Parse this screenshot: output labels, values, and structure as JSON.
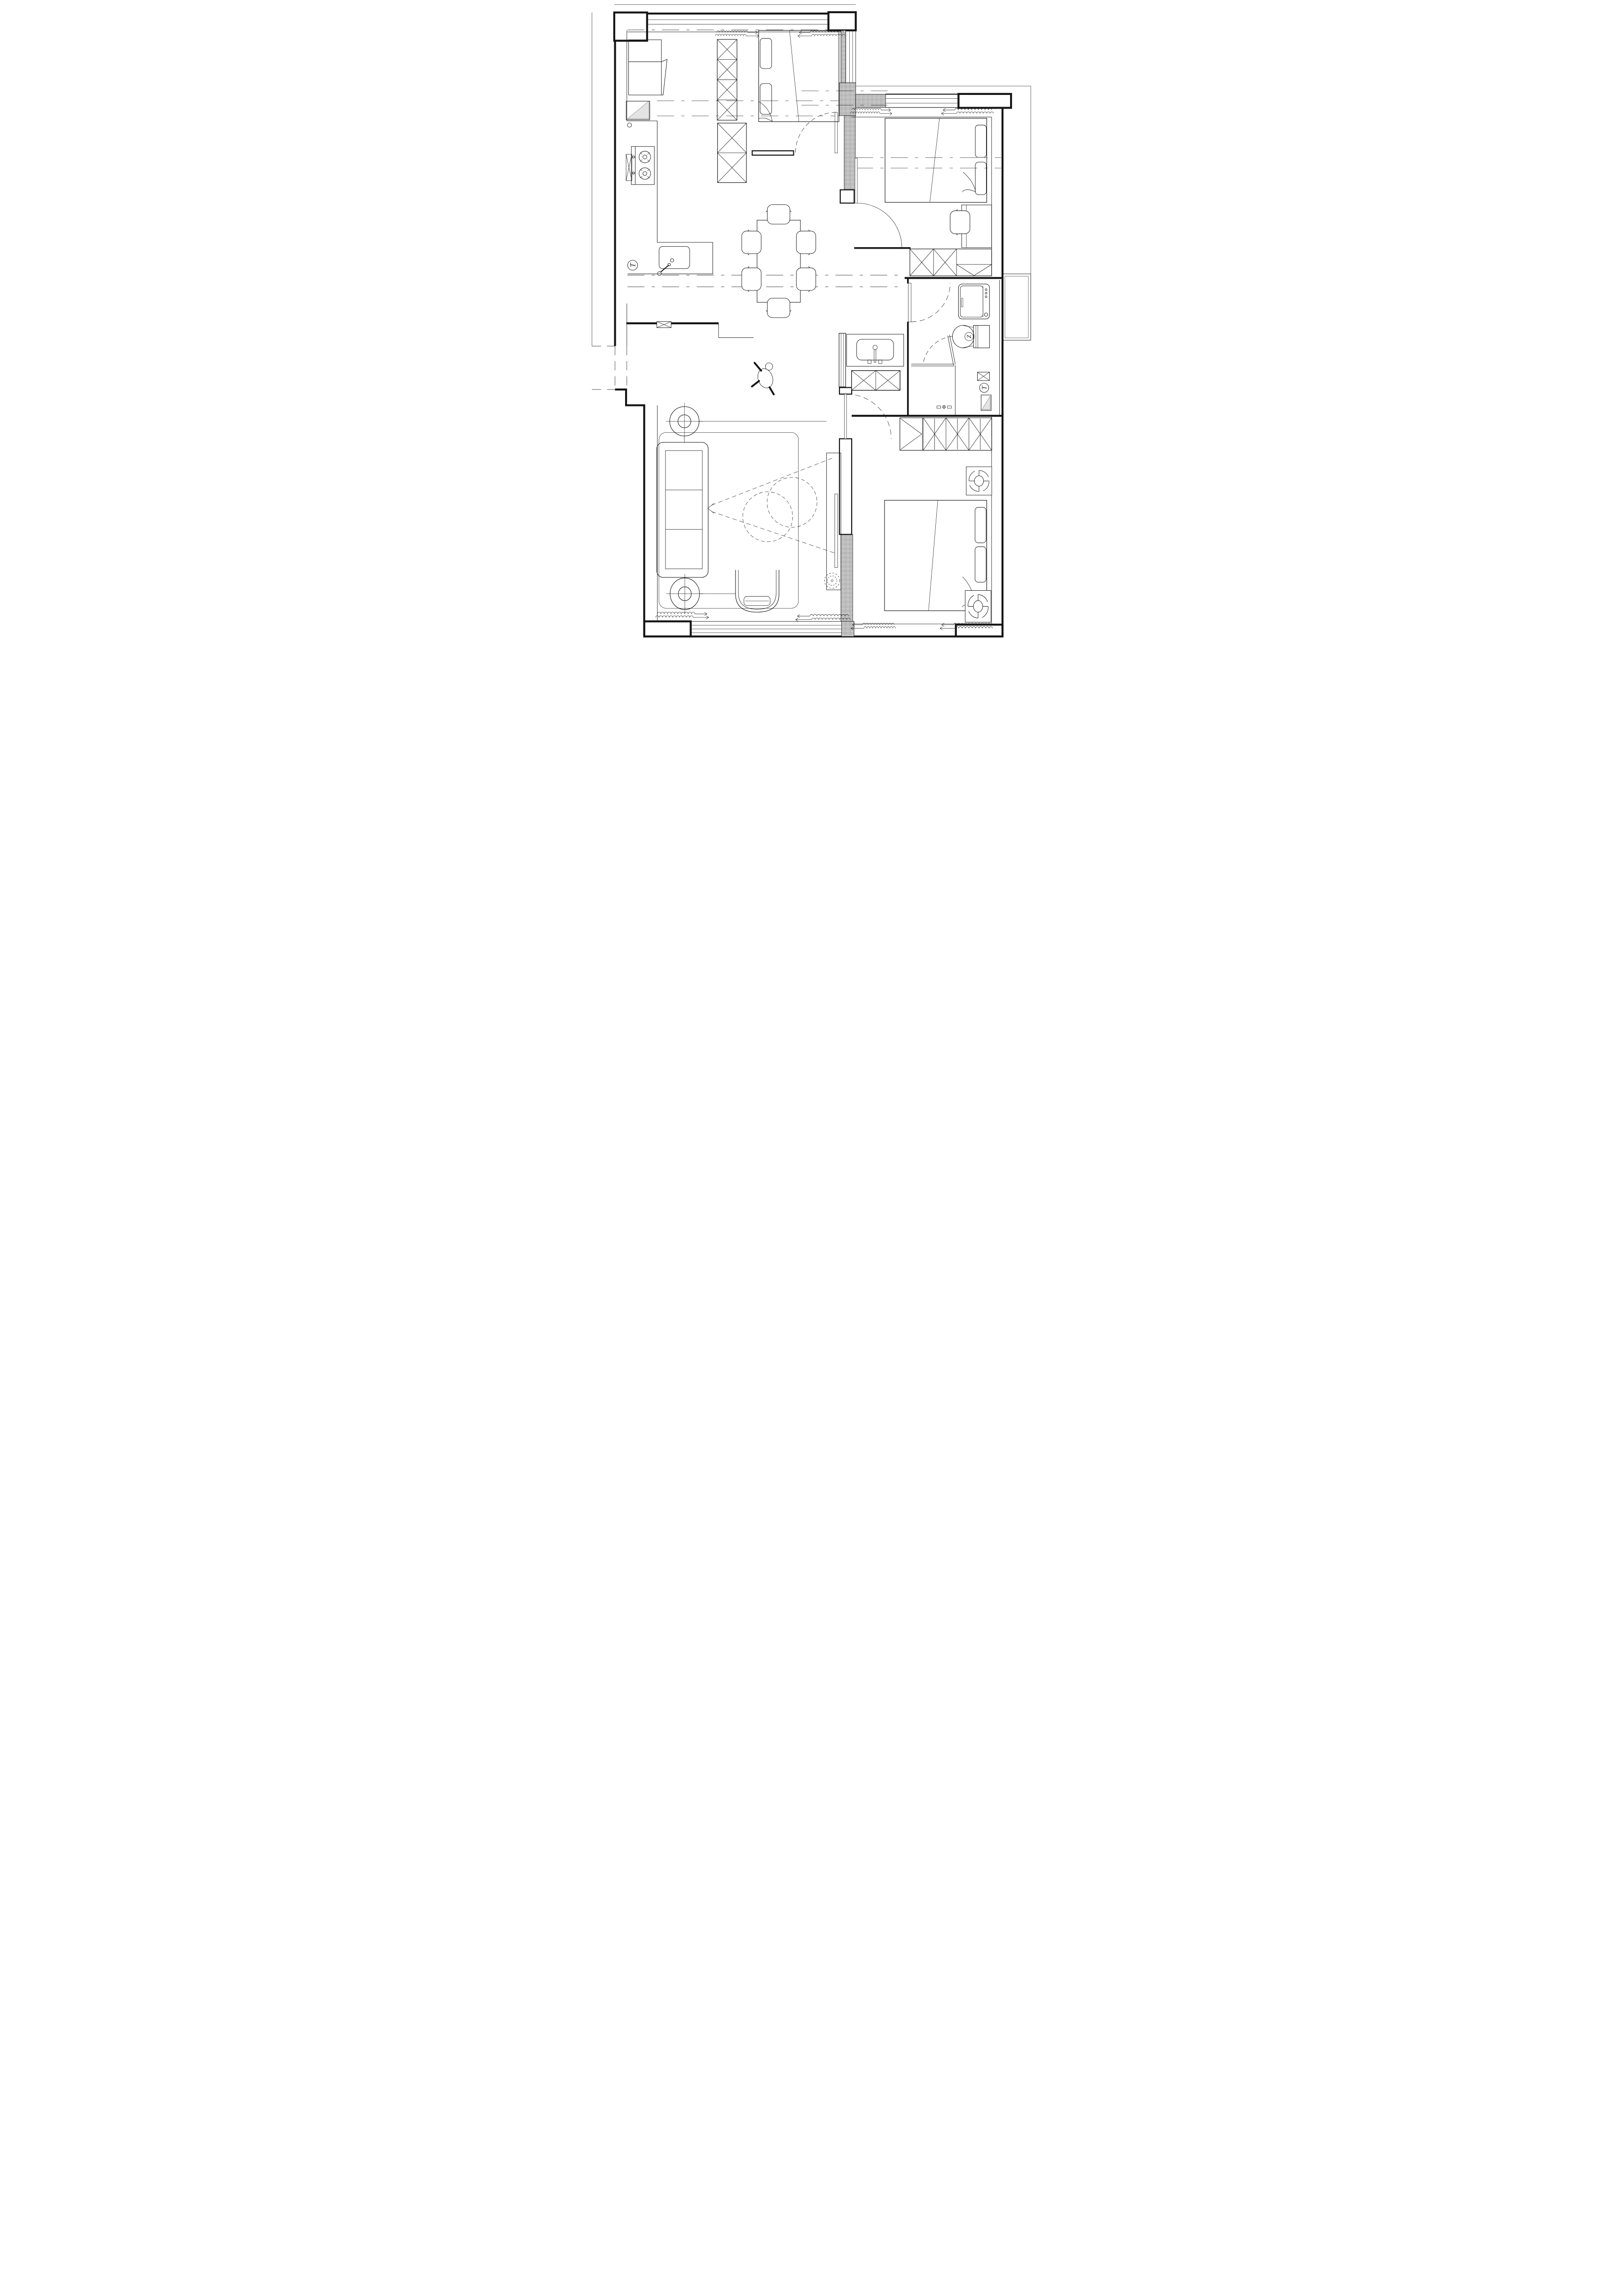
{
  "document": {
    "type": "architectural-floor-plan",
    "background_color": "#ffffff",
    "ink_color": "#141414",
    "wall_hatch": "crosshatch",
    "window_symbol": "squiggle-insulation-with-arrows"
  },
  "annotations": {
    "toilet_logo": "Z",
    "kitchen_floor_drain": "T",
    "bath_floor_drain": "T"
  },
  "counts": {
    "dining_chairs": 6,
    "stove_burners": 2,
    "round_ceiling_fans": 2,
    "box_exhaust_fans": 2,
    "beds": 3,
    "wardrobes": 3,
    "doors_swing": 4
  },
  "rooms": [
    {
      "name": "bedroom-top-left",
      "furniture": [
        "desk-daybed",
        "tall-wardrobe",
        "storage-cabinet",
        "double-bed",
        "swing-door",
        "windows"
      ]
    },
    {
      "name": "kitchen",
      "furniture": [
        "l-counter",
        "gas-stove",
        "sink",
        "floor-drain",
        "shoe-cabinet",
        "vent-box"
      ]
    },
    {
      "name": "dining",
      "furniture": [
        "dining-table",
        "six-chairs",
        "person-figure"
      ]
    },
    {
      "name": "bedroom-top-right",
      "furniture": [
        "double-bed",
        "desk",
        "chair",
        "wardrobe",
        "swing-door",
        "windows"
      ]
    },
    {
      "name": "bathroom",
      "furniture": [
        "washing-machine",
        "toilet",
        "shower-glass",
        "pocket-door",
        "vent-box",
        "floor-drain",
        "water-heater",
        "shower-valve"
      ]
    },
    {
      "name": "hallway",
      "furniture": [
        "vanity-basin",
        "screen-partition",
        "x-cabinet"
      ]
    },
    {
      "name": "living-room",
      "furniture": [
        "sofa",
        "rug",
        "ceiling-fan",
        "oval-fan",
        "lounge-chair",
        "tv-cabinet",
        "tv",
        "coffee-tables",
        "plant",
        "windows"
      ]
    },
    {
      "name": "bedroom-bottom-right",
      "furniture": [
        "wardrobe",
        "double-bed",
        "exhaust-fan",
        "exhaust-fan",
        "swing-door",
        "windows"
      ]
    }
  ]
}
